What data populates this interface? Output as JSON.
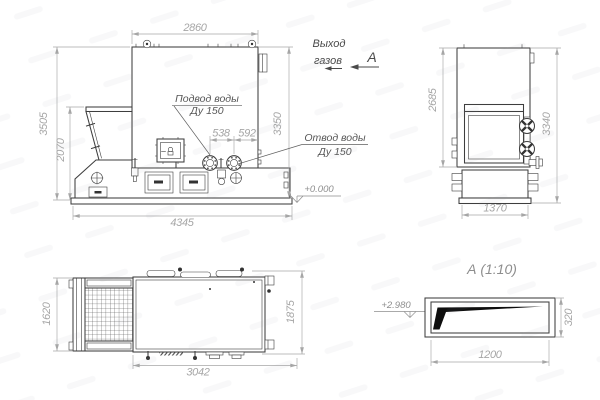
{
  "colors": {
    "background": "#ffffff",
    "line": "#3e3e3e",
    "dimension": "#a6a6a6",
    "label": "#565656",
    "annotation": "#4a4a4a",
    "detail_fill": "#0e0e0e"
  },
  "views": {
    "front": {
      "dim_top": "2860",
      "dim_left_outer": "3505",
      "dim_left_inner": "2070",
      "dim_right": "3350",
      "dim_flange_a": "538",
      "dim_flange_b": "592",
      "dim_bottom": "4345",
      "label_supply_line1": "Подвод воды",
      "label_supply_line2": "Ду 150",
      "label_return_line1": "Отвод воды",
      "label_return_line2": "Ду 150",
      "level_mark": "+0.000"
    },
    "gas": {
      "line1": "Выход",
      "line2": "газов",
      "view_label": "А"
    },
    "side": {
      "dim_left": "2685",
      "dim_right": "3340",
      "dim_bottom": "1370"
    },
    "plan": {
      "dim_left": "1620",
      "dim_right": "1875",
      "dim_bottom": "3042"
    },
    "detail": {
      "title": "А (1:10)",
      "dim_bottom": "1200",
      "dim_right": "320",
      "level_mark": "+2.980"
    }
  }
}
